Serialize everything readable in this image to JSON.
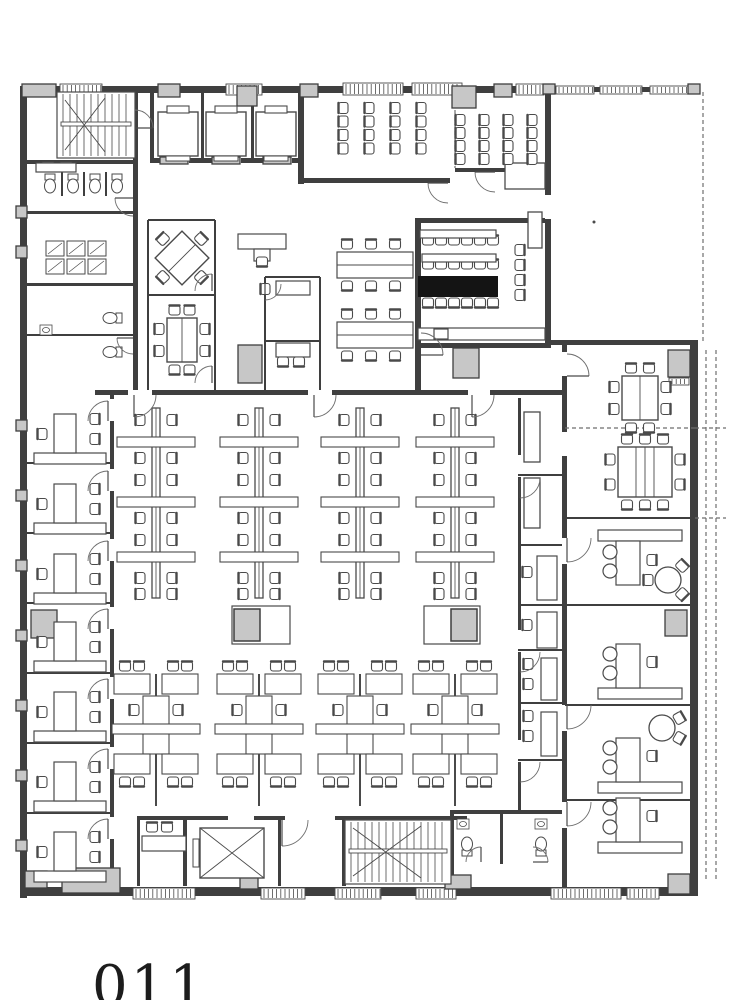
{
  "figure": {
    "caption": "011"
  },
  "colors": {
    "paper": "#ffffff",
    "wall": "#3f3f3f",
    "line": "#4a4a4a",
    "thin": "#6e6e6e",
    "gray_fill": "#c7c7c7",
    "light_fill": "#e4e4e4",
    "black_fill": "#141414"
  },
  "plan": {
    "canvas": {
      "width": 735,
      "height": 1000
    },
    "walls": [
      [
        20,
        86,
        530,
        7
      ],
      [
        548,
        87,
        148,
        5
      ],
      [
        20,
        86,
        7,
        812
      ],
      [
        20,
        887,
        678,
        9
      ],
      [
        690,
        340,
        8,
        550
      ],
      [
        545,
        93,
        6,
        252
      ],
      [
        551,
        340,
        147,
        5
      ],
      [
        133,
        93,
        5,
        302
      ],
      [
        27,
        160,
        108,
        4
      ],
      [
        27,
        211,
        108,
        3
      ],
      [
        27,
        283,
        108,
        3
      ],
      [
        95,
        390,
        468,
        5
      ],
      [
        150,
        158,
        152,
        5
      ],
      [
        298,
        90,
        6,
        94
      ],
      [
        298,
        178,
        152,
        5
      ],
      [
        455,
        168,
        90,
        4
      ],
      [
        415,
        218,
        6,
        172
      ],
      [
        415,
        218,
        132,
        5
      ],
      [
        415,
        343,
        136,
        5
      ],
      [
        110,
        395,
        4,
        488
      ],
      [
        518,
        398,
        3,
        415
      ],
      [
        562,
        345,
        5,
        543
      ],
      [
        137,
        816,
        148,
        4
      ],
      [
        335,
        816,
        132,
        4
      ],
      [
        137,
        816,
        3,
        70
      ],
      [
        183,
        816,
        4,
        70
      ],
      [
        278,
        816,
        3,
        70
      ],
      [
        342,
        816,
        4,
        70
      ],
      [
        450,
        810,
        4,
        78
      ],
      [
        453,
        810,
        110,
        4
      ],
      [
        500,
        814,
        3,
        50
      ],
      [
        150,
        90,
        4,
        70
      ],
      [
        201,
        92,
        3,
        66
      ],
      [
        251,
        92,
        3,
        66
      ]
    ],
    "wall_gaps": [
      [
        163,
        158,
        26,
        5
      ],
      [
        215,
        158,
        26,
        5
      ],
      [
        266,
        158,
        26,
        5
      ],
      [
        128,
        390,
        24,
        5
      ],
      [
        308,
        390,
        24,
        5
      ],
      [
        468,
        390,
        22,
        5
      ],
      [
        228,
        816,
        26,
        4
      ],
      [
        296,
        816,
        24,
        4
      ],
      [
        110,
        399,
        4,
        22
      ],
      [
        110,
        469,
        4,
        22
      ],
      [
        110,
        539,
        4,
        22
      ],
      [
        110,
        607,
        4,
        22
      ],
      [
        110,
        677,
        4,
        22
      ],
      [
        110,
        747,
        4,
        22
      ],
      [
        110,
        817,
        4,
        22
      ],
      [
        518,
        455,
        3,
        22
      ],
      [
        518,
        630,
        3,
        22
      ],
      [
        518,
        740,
        3,
        22
      ],
      [
        562,
        352,
        5,
        24
      ],
      [
        562,
        432,
        5,
        24
      ],
      [
        562,
        538,
        5,
        26
      ],
      [
        562,
        705,
        5,
        26
      ],
      [
        562,
        802,
        5,
        26
      ],
      [
        545,
        195,
        6,
        24
      ]
    ],
    "partitions": [
      [
        27,
        463,
        112,
        463
      ],
      [
        27,
        533,
        112,
        533
      ],
      [
        27,
        603,
        112,
        603
      ],
      [
        27,
        673,
        112,
        673
      ],
      [
        27,
        743,
        112,
        743
      ],
      [
        27,
        813,
        112,
        813
      ],
      [
        148,
        220,
        148,
        390
      ],
      [
        215,
        220,
        215,
        390
      ],
      [
        148,
        220,
        215,
        220
      ],
      [
        148,
        295,
        215,
        295
      ],
      [
        265,
        277,
        265,
        390
      ],
      [
        320,
        277,
        320,
        390
      ],
      [
        265,
        277,
        320,
        277
      ],
      [
        265,
        341,
        320,
        341
      ],
      [
        62,
        172,
        62,
        196
      ],
      [
        84,
        172,
        84,
        196
      ],
      [
        106,
        172,
        106,
        196
      ],
      [
        27,
        335,
        133,
        335
      ],
      [
        565,
        518,
        690,
        518
      ],
      [
        565,
        605,
        690,
        605
      ],
      [
        565,
        705,
        690,
        705
      ],
      [
        565,
        800,
        690,
        800
      ],
      [
        518,
        475,
        562,
        475
      ],
      [
        518,
        545,
        562,
        545
      ],
      [
        518,
        605,
        562,
        605
      ],
      [
        518,
        650,
        562,
        650
      ],
      [
        518,
        703,
        562,
        703
      ],
      [
        518,
        760,
        562,
        760
      ]
    ],
    "dashed_lines": [
      [
        703,
        92,
        703,
        343
      ],
      [
        706,
        350,
        706,
        880
      ],
      [
        716,
        350,
        716,
        880
      ],
      [
        565,
        428,
        695,
        428
      ],
      [
        695,
        428,
        726,
        428
      ],
      [
        455,
        103,
        455,
        168
      ],
      [
        695,
        518,
        726,
        518
      ]
    ],
    "windows": [
      [
        60,
        84,
        42,
        11
      ],
      [
        226,
        84,
        36,
        11
      ],
      [
        343,
        83,
        60,
        12
      ],
      [
        412,
        83,
        50,
        12
      ],
      [
        516,
        84,
        28,
        11
      ],
      [
        556,
        86,
        38,
        8
      ],
      [
        600,
        86,
        42,
        8
      ],
      [
        650,
        86,
        38,
        8
      ],
      [
        133,
        888,
        62,
        11
      ],
      [
        261,
        888,
        44,
        11
      ],
      [
        335,
        888,
        46,
        11
      ],
      [
        416,
        888,
        40,
        11
      ],
      [
        551,
        888,
        70,
        11
      ],
      [
        627,
        888,
        32,
        11
      ],
      [
        669,
        378,
        20,
        7
      ]
    ],
    "piers": [
      [
        22,
        84,
        34,
        13
      ],
      [
        158,
        84,
        22,
        13
      ],
      [
        237,
        86,
        20,
        20
      ],
      [
        300,
        84,
        18,
        13
      ],
      [
        452,
        86,
        24,
        22
      ],
      [
        494,
        84,
        18,
        13
      ],
      [
        543,
        84,
        12,
        10
      ],
      [
        688,
        84,
        12,
        10
      ],
      [
        16,
        206,
        11,
        12
      ],
      [
        16,
        246,
        11,
        12
      ],
      [
        16,
        420,
        11,
        11
      ],
      [
        16,
        490,
        11,
        11
      ],
      [
        16,
        560,
        11,
        11
      ],
      [
        16,
        630,
        11,
        11
      ],
      [
        16,
        700,
        11,
        11
      ],
      [
        16,
        770,
        11,
        11
      ],
      [
        16,
        840,
        11,
        11
      ],
      [
        238,
        345,
        24,
        38
      ],
      [
        453,
        348,
        26,
        30
      ],
      [
        668,
        350,
        22,
        27
      ],
      [
        665,
        610,
        22,
        26
      ],
      [
        31,
        610,
        26,
        28
      ],
      [
        62,
        868,
        58,
        25
      ],
      [
        25,
        871,
        22,
        17
      ],
      [
        668,
        874,
        22,
        20
      ],
      [
        445,
        875,
        26,
        14
      ],
      [
        240,
        876,
        18,
        13
      ],
      [
        160,
        157,
        28,
        7
      ],
      [
        212,
        157,
        28,
        7
      ],
      [
        263,
        157,
        28,
        7
      ]
    ],
    "light_boxes": [
      [
        505,
        163,
        40,
        26
      ],
      [
        528,
        212,
        14,
        36
      ],
      [
        524,
        412,
        16,
        50
      ],
      [
        524,
        478,
        16,
        50
      ]
    ],
    "black_boxes": [
      [
        418,
        276,
        80,
        21
      ]
    ],
    "stairs": [
      [
        57,
        92,
        78,
        66,
        124
      ],
      [
        345,
        820,
        106,
        64,
        851
      ]
    ],
    "elevators": [
      [
        158,
        112
      ],
      [
        206,
        112
      ],
      [
        256,
        112
      ]
    ],
    "freight_elevators": [
      [
        200,
        828,
        64,
        50
      ]
    ],
    "chair_grids": [
      [
        343,
        108,
        4,
        4,
        26,
        13.5,
        "r"
      ],
      [
        460,
        120,
        4,
        4,
        24,
        13,
        "r"
      ],
      [
        428,
        240,
        6,
        1,
        13,
        0,
        "d"
      ],
      [
        428,
        264,
        6,
        1,
        13,
        0,
        "d"
      ],
      [
        428,
        303,
        6,
        1,
        13,
        0,
        "u"
      ],
      [
        520,
        250,
        1,
        4,
        0,
        15,
        "l"
      ]
    ],
    "bench_clusters": [
      [
        337,
        240
      ],
      [
        337,
        310
      ]
    ],
    "spines": [
      [
        156,
        408
      ],
      [
        259,
        408
      ],
      [
        360,
        408
      ],
      [
        455,
        408
      ]
    ],
    "pods": [
      [
        156,
        658
      ],
      [
        259,
        658
      ],
      [
        360,
        658
      ],
      [
        455,
        658
      ]
    ],
    "offices_left": [
      397,
      467,
      537,
      605,
      675,
      745,
      815
    ],
    "offices_right": [
      [
        518,
        1,
        530
      ],
      [
        605,
        0,
        688
      ],
      [
        705,
        0,
        782
      ],
      [
        800,
        0,
        842
      ]
    ],
    "meeting_tables": [
      [
        182,
        258,
        38,
        38,
        1,
        1,
        1,
        1,
        45
      ],
      [
        182,
        340,
        30,
        44,
        2,
        2,
        2,
        2,
        0
      ],
      [
        640,
        398,
        36,
        44,
        2,
        2,
        2,
        2,
        0
      ],
      [
        645,
        472,
        54,
        50,
        3,
        3,
        2,
        2,
        0
      ]
    ],
    "round_tables": [
      [
        668,
        580,
        13,
        [
          45,
          180,
          315
        ]
      ],
      [
        662,
        728,
        13,
        [
          30,
          330
        ]
      ]
    ],
    "copiers": [
      [
        232,
        606,
        58,
        38,
        2
      ],
      [
        424,
        606,
        56,
        38,
        27
      ]
    ],
    "toilets": [
      [
        50,
        184,
        0
      ],
      [
        73,
        184,
        0
      ],
      [
        95,
        184,
        0
      ],
      [
        117,
        184,
        0
      ],
      [
        112,
        318,
        90
      ],
      [
        112,
        352,
        90
      ],
      [
        467,
        846,
        180
      ],
      [
        541,
        846,
        180
      ]
    ],
    "sinks": [
      [
        48,
        167
      ],
      [
        66,
        167
      ],
      [
        441,
        334
      ],
      [
        463,
        824
      ],
      [
        541,
        824
      ],
      [
        46,
        330
      ]
    ],
    "lockers": [
      [
        46,
        241,
        3,
        2
      ]
    ],
    "desks": [
      [
        36,
        163,
        40,
        9
      ],
      [
        418,
        328,
        127,
        12
      ],
      [
        434,
        329,
        14,
        10
      ],
      [
        238,
        234,
        48,
        15
      ],
      [
        254,
        249,
        16,
        12
      ],
      [
        276,
        281,
        34,
        14
      ],
      [
        276,
        343,
        34,
        14
      ],
      [
        537,
        556,
        20,
        44
      ],
      [
        537,
        612,
        20,
        36
      ],
      [
        541,
        658,
        16,
        42
      ],
      [
        541,
        712,
        16,
        44
      ],
      [
        422,
        254,
        74,
        8
      ],
      [
        420,
        230,
        76,
        8
      ],
      [
        142,
        836,
        44,
        15
      ]
    ],
    "chairs": [
      [
        262,
        262,
        180
      ],
      [
        265,
        289,
        270
      ],
      [
        283,
        362,
        180
      ],
      [
        299,
        362,
        180
      ],
      [
        152,
        827,
        0
      ],
      [
        167,
        827,
        0
      ],
      [
        527,
        572,
        270
      ],
      [
        527,
        625,
        270
      ],
      [
        528,
        664,
        270
      ],
      [
        528,
        684,
        270
      ],
      [
        528,
        716,
        270
      ],
      [
        528,
        736,
        270
      ]
    ],
    "door_arcs": [
      [
        108,
        421,
        20,
        180,
        270,
        1
      ],
      [
        108,
        491,
        20,
        180,
        270,
        1
      ],
      [
        108,
        561,
        20,
        180,
        270,
        1
      ],
      [
        108,
        629,
        20,
        180,
        270,
        1
      ],
      [
        108,
        699,
        20,
        180,
        270,
        1
      ],
      [
        108,
        769,
        20,
        180,
        270,
        1
      ],
      [
        108,
        839,
        20,
        180,
        270,
        1
      ],
      [
        212,
        291,
        17,
        180,
        270,
        1
      ],
      [
        212,
        383,
        17,
        180,
        270,
        1
      ],
      [
        265,
        284,
        16,
        0,
        90,
        1
      ],
      [
        448,
        183,
        20,
        90,
        180,
        1
      ],
      [
        495,
        172,
        20,
        90,
        180,
        1
      ],
      [
        421,
        355,
        22,
        270,
        360,
        1
      ],
      [
        134,
        395,
        22,
        0,
        90,
        1
      ],
      [
        314,
        395,
        22,
        0,
        90,
        1
      ],
      [
        472,
        395,
        22,
        0,
        90,
        1
      ],
      [
        282,
        820,
        26,
        0,
        90,
        1
      ],
      [
        481,
        862,
        15,
        180,
        270,
        1
      ],
      [
        533,
        862,
        15,
        270,
        360,
        1
      ],
      [
        567,
        376,
        22,
        270,
        360,
        1
      ],
      [
        567,
        538,
        24,
        0,
        90,
        1
      ],
      [
        567,
        705,
        24,
        0,
        90,
        1
      ],
      [
        567,
        802,
        24,
        0,
        90,
        1
      ],
      [
        520,
        478,
        20,
        0,
        90,
        1
      ],
      [
        520,
        652,
        20,
        0,
        90,
        1
      ],
      [
        520,
        762,
        20,
        0,
        90,
        1
      ],
      [
        133,
        198,
        18,
        90,
        180,
        1
      ],
      [
        133,
        338,
        16,
        90,
        180,
        1
      ],
      [
        135,
        128,
        18,
        270,
        360,
        1
      ]
    ],
    "dots": [
      [
        594,
        222
      ]
    ]
  }
}
